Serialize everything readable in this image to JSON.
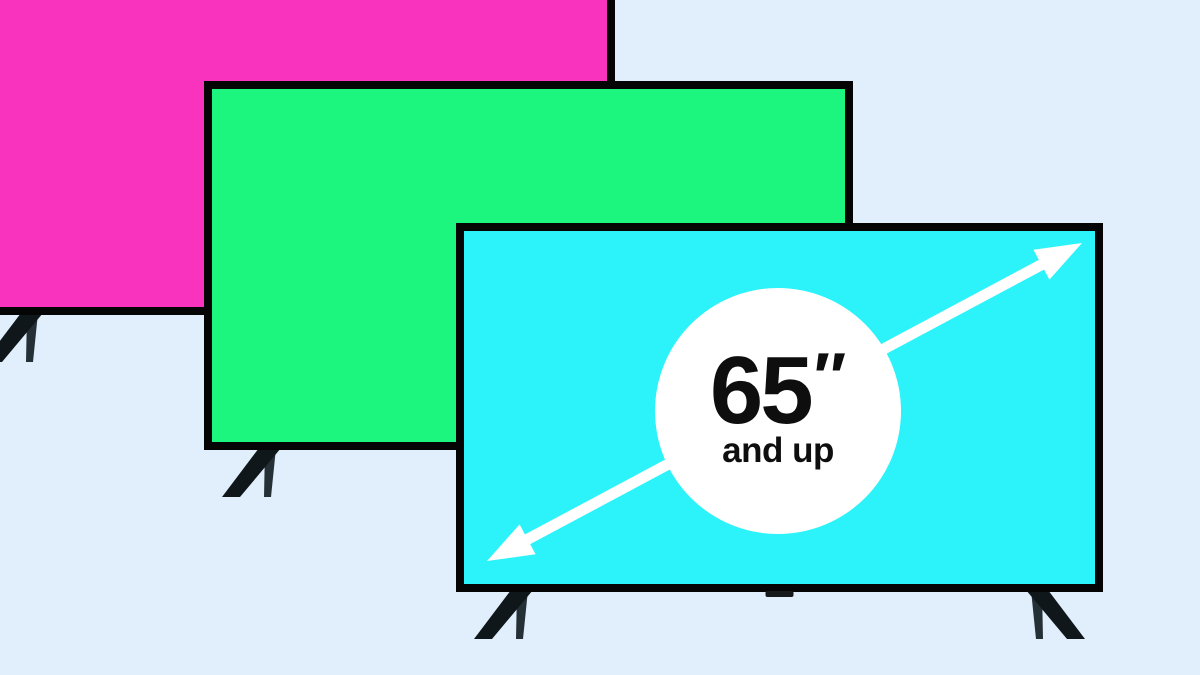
{
  "scene": {
    "background_color": "#E0EFFB",
    "frame_color": "#050505",
    "stand_color_front": "#10171A",
    "stand_color_back": "#253036",
    "sensor_color": "#15191C",
    "tvs": [
      {
        "name": "tv-pink",
        "x": -34,
        "y": -54,
        "width": 649,
        "height": 369,
        "screen_color": "#F933BD"
      },
      {
        "name": "tv-green",
        "x": 204,
        "y": 81,
        "width": 649,
        "height": 369,
        "screen_color": "#1CF67E"
      },
      {
        "name": "tv-cyan",
        "x": 456,
        "y": 223,
        "width": 647,
        "height": 369,
        "screen_color": "#2BF3F9"
      }
    ],
    "arrow": {
      "color": "#FFFFFF",
      "x1": 487,
      "y1": 561,
      "x2": 1082,
      "y2": 243,
      "stroke_width": 11,
      "head_length": 46,
      "head_width": 34
    }
  },
  "badge": {
    "circle_color": "#FFFFFF",
    "text_color": "#0E0E0E",
    "cx": 778,
    "cy": 411,
    "r": 123,
    "size_value": "65",
    "size_unit": "″",
    "subtitle": "and up"
  }
}
